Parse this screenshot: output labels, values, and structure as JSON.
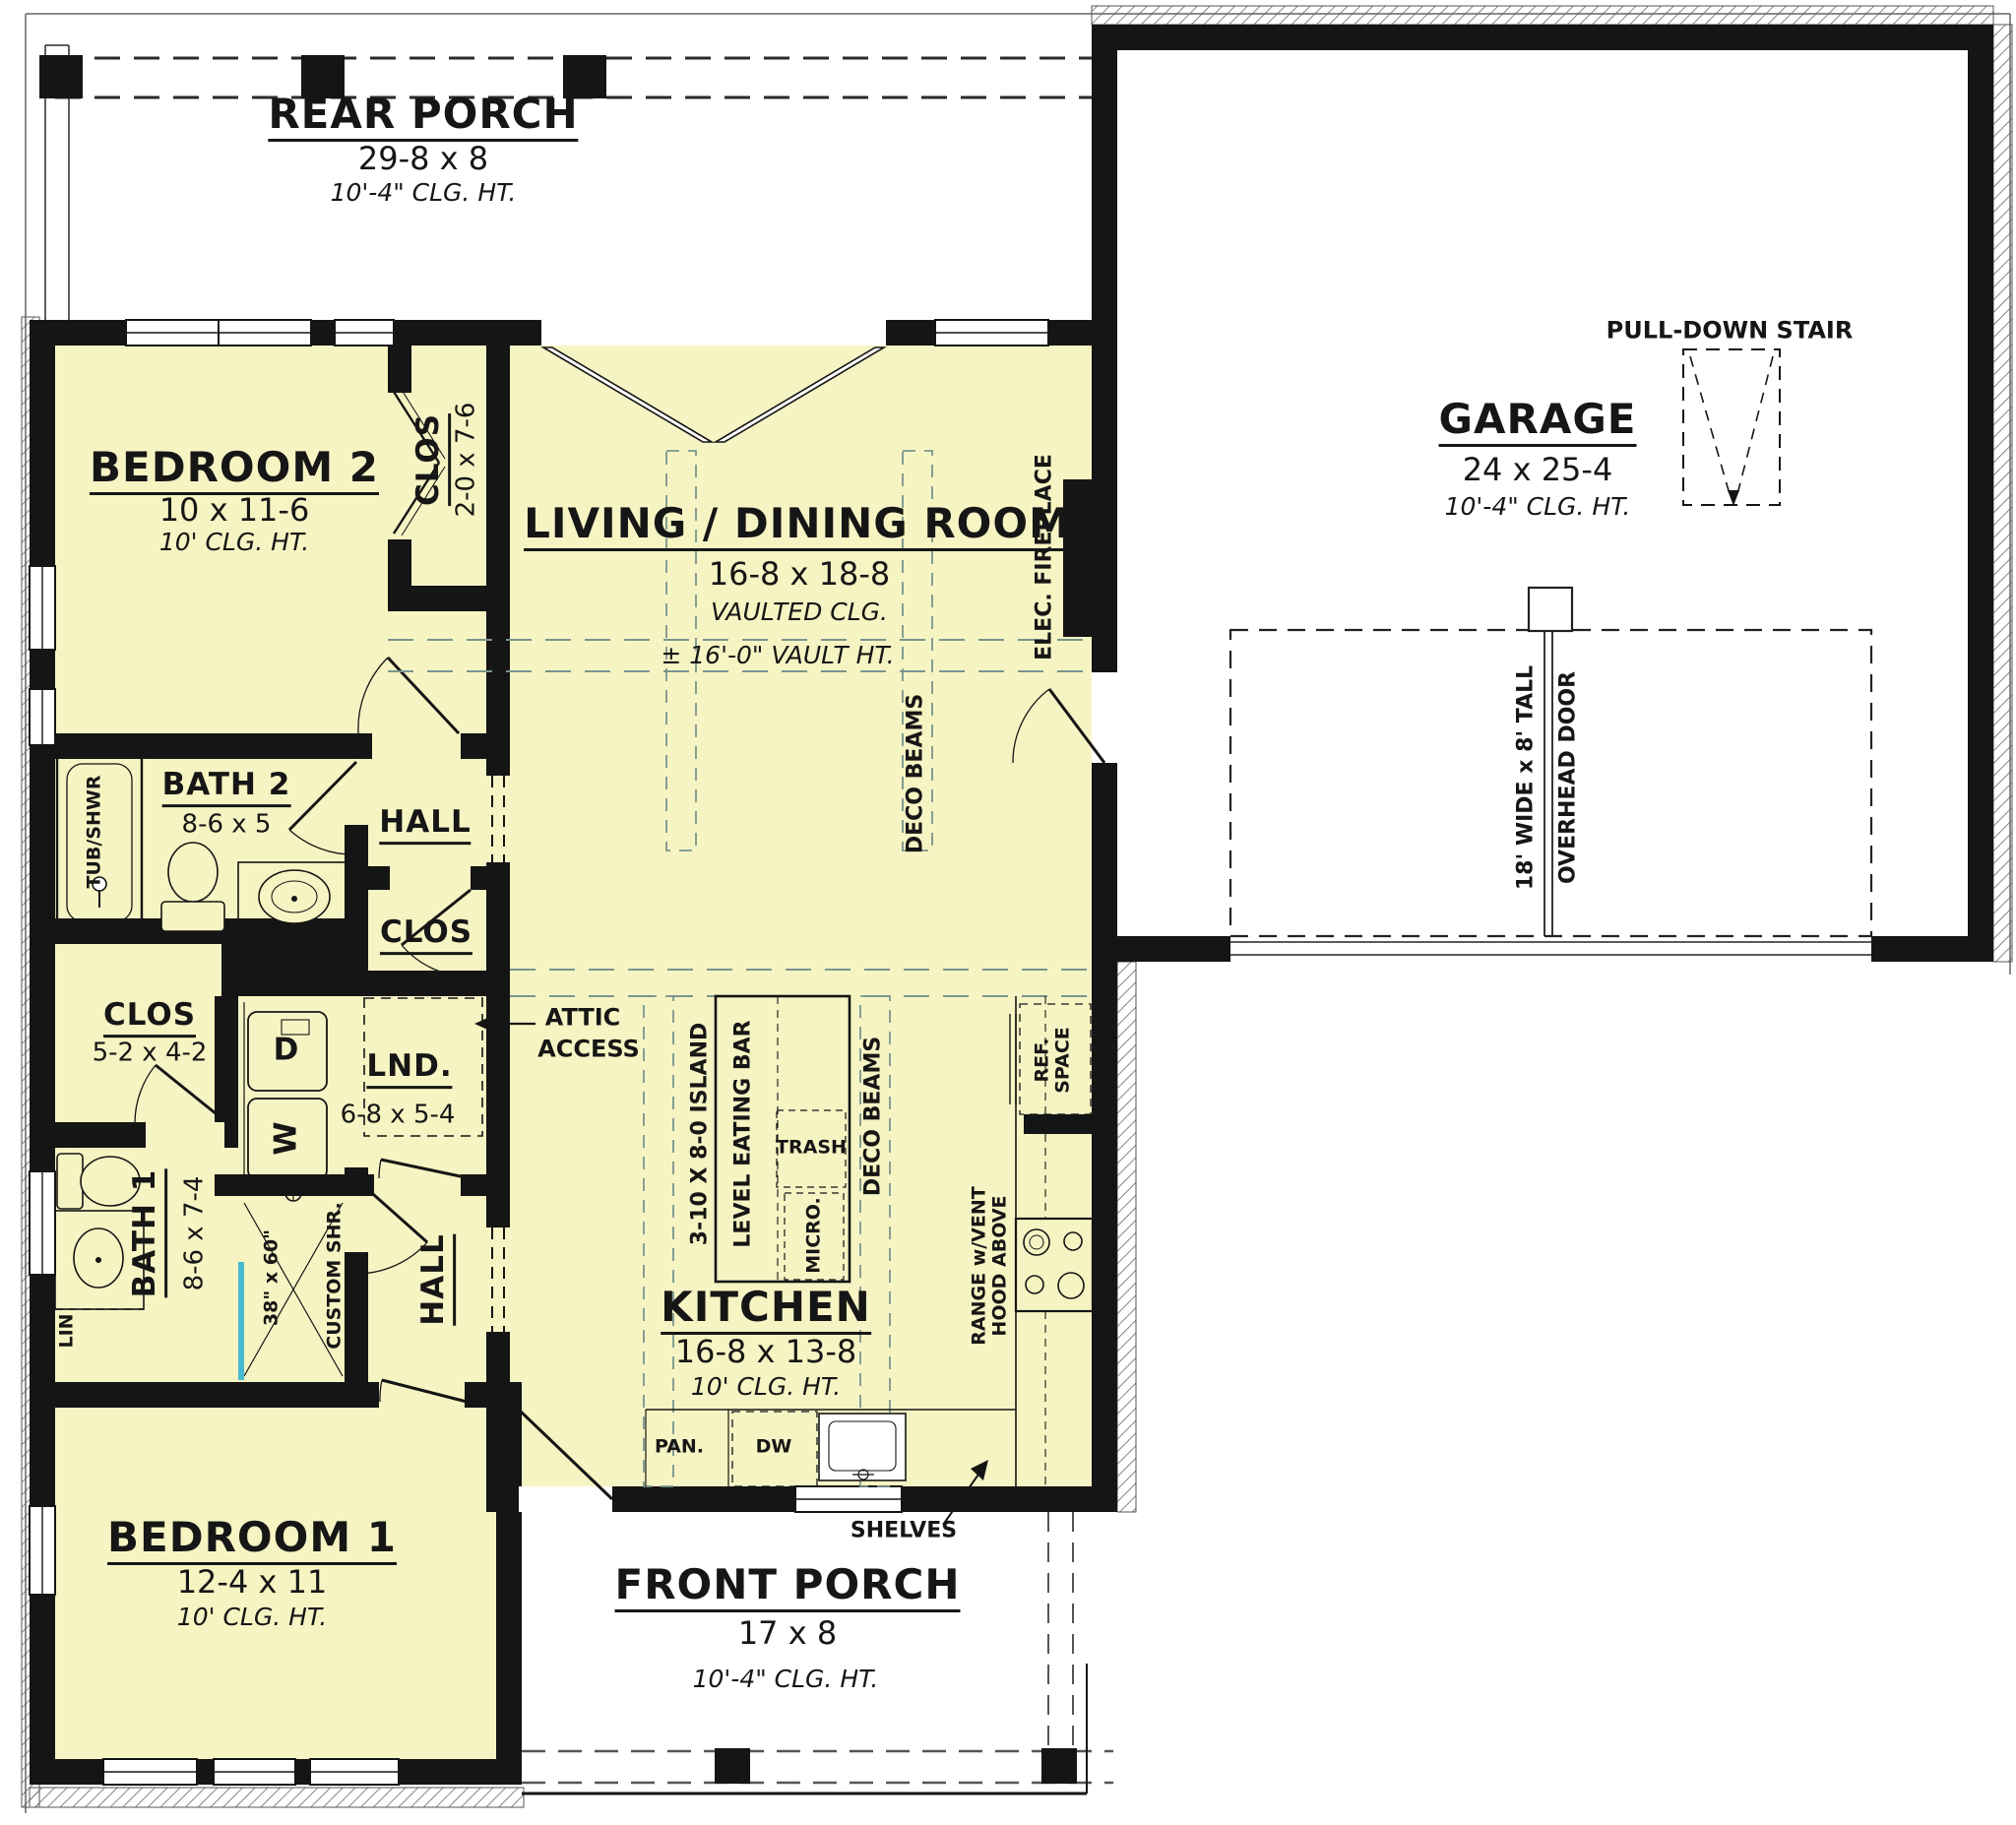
{
  "plan": {
    "rooms": {
      "rear_porch": {
        "name": "REAR PORCH",
        "dims": "29-8 x 8",
        "ceiling": "10'-4\" CLG. HT."
      },
      "garage": {
        "name": "GARAGE",
        "dims": "24 x 25-4",
        "ceiling": "10'-4\" CLG. HT."
      },
      "living_dining": {
        "name": "LIVING / DINING ROOM",
        "dims": "16-8 x 18-8",
        "ceiling": "VAULTED CLG.",
        "vault_note": "± 16'-0\" VAULT HT."
      },
      "bedroom2": {
        "name": "BEDROOM 2",
        "dims": "10 x 11-6",
        "ceiling": "10' CLG. HT."
      },
      "bedroom1": {
        "name": "BEDROOM 1",
        "dims": "12-4 x 11",
        "ceiling": "10' CLG. HT."
      },
      "kitchen": {
        "name": "KITCHEN",
        "dims": "16-8 x 13-8",
        "ceiling": "10' CLG. HT."
      },
      "bath2": {
        "name": "BATH 2",
        "dims": "8-6 x 5"
      },
      "bath1": {
        "name": "BATH 1",
        "dims": "8-6 x 7-4"
      },
      "front_porch": {
        "name": "FRONT PORCH",
        "dims": "17 x 8",
        "ceiling": "10'-4\" CLG. HT."
      },
      "hall_upper": {
        "name": "HALL"
      },
      "hall_lower": {
        "name": "HALL"
      },
      "clos_bedroom2": {
        "name": "CLOS",
        "dims": "2-0 x 7-6"
      },
      "clos_hall": {
        "name": "CLOS"
      },
      "clos_bath1": {
        "name": "CLOS",
        "dims": "5-2 x 4-2"
      },
      "laundry": {
        "name": "LND.",
        "dims": "6-8 x 5-4"
      }
    },
    "annotations": {
      "pull_down_stair": "PULL-DOWN STAIR",
      "overhead_door_line1": "18' WIDE x 8' TALL",
      "overhead_door_line2": "OVERHEAD DOOR",
      "elec_fireplace": "ELEC. FIREPLACE",
      "deco_beams": "DECO BEAMS",
      "attic_line1": "ATTIC",
      "attic_line2": "ACCESS",
      "tub_shwr": "TUB/SHWR",
      "lin": "LIN",
      "custom_shr": "CUSTOM SHR.",
      "shr_dims": "38\" x 60\"",
      "island_dims": "3-10 X 8-0 ISLAND",
      "eating_bar": "LEVEL EATING BAR",
      "trash": "TRASH",
      "micro": "MICRO.",
      "ref_line1": "REF.",
      "ref_line2": "SPACE",
      "range_line1": "RANGE w/VENT",
      "range_line2": "HOOD ABOVE",
      "pan": "PAN.",
      "dw": "DW",
      "shelves": "SHELVES",
      "washer": "W",
      "dryer": "D"
    },
    "colors": {
      "floor_yellow": "#F6F4C3",
      "wall_black": "#151515",
      "beam_teal": "#7A958E",
      "glass_blue": "#49B9CF"
    }
  }
}
